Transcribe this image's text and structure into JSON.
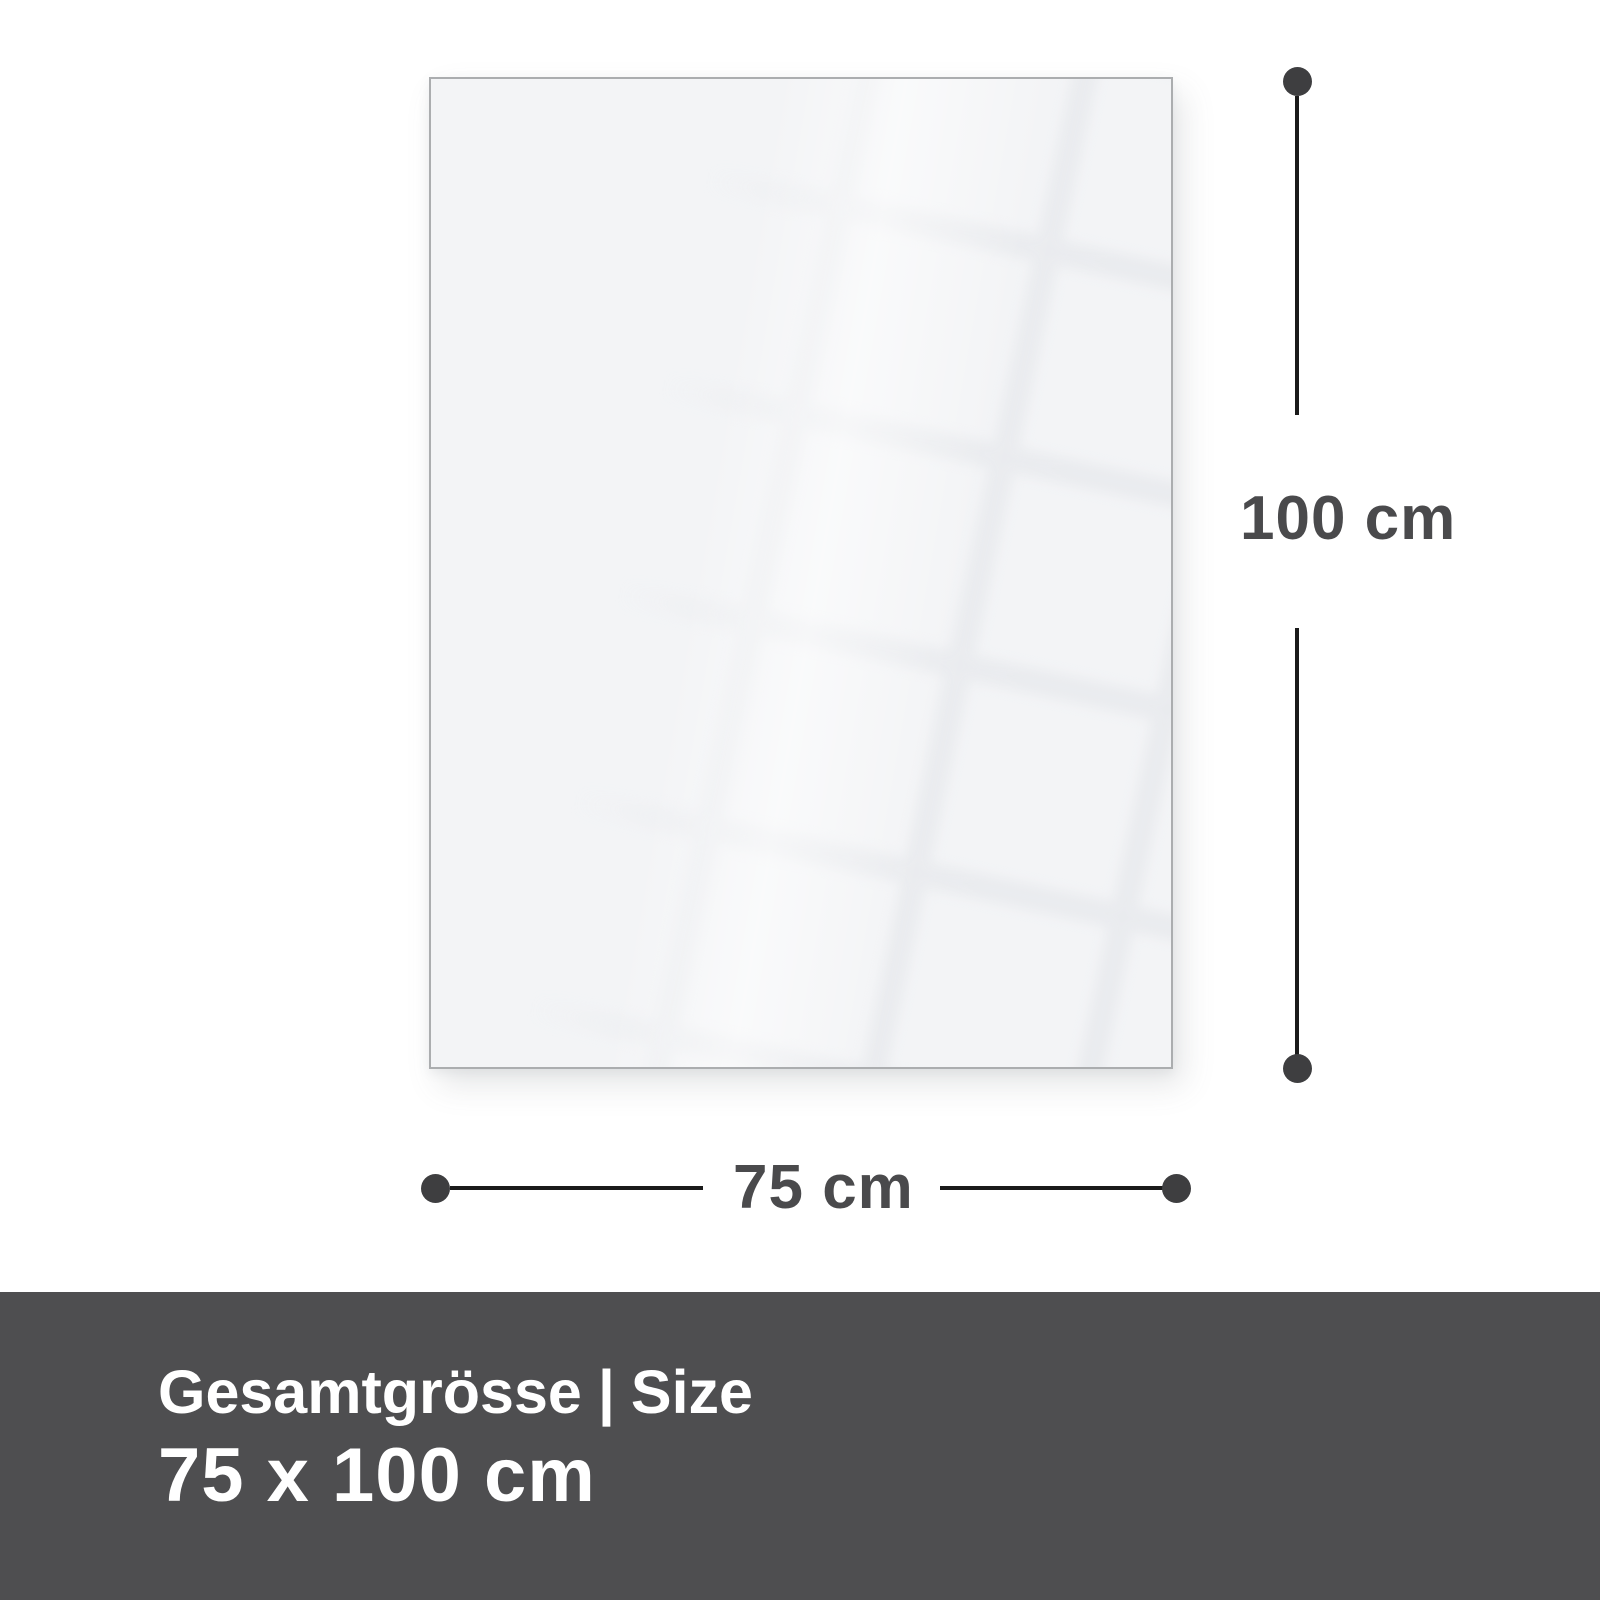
{
  "panel": {
    "description": "blank glossy panel with window reflection"
  },
  "dimensions": {
    "height_label": "100 cm",
    "width_label": "75 cm"
  },
  "footer": {
    "title_de": "Gesamtgrösse",
    "separator": "|",
    "title_en": "Size",
    "size_value": "75 x 100 cm"
  },
  "colors": {
    "page_bg": "#ffffff",
    "panel_bg": "#f3f4f6",
    "panel_border": "#abadaf",
    "reflection_line": "#e4e6ea",
    "line": "#1a1a1a",
    "dot": "#3e3e40",
    "dim_label": "#4a4a4c",
    "footer_bg": "#4e4e50",
    "footer_text": "#ffffff"
  }
}
